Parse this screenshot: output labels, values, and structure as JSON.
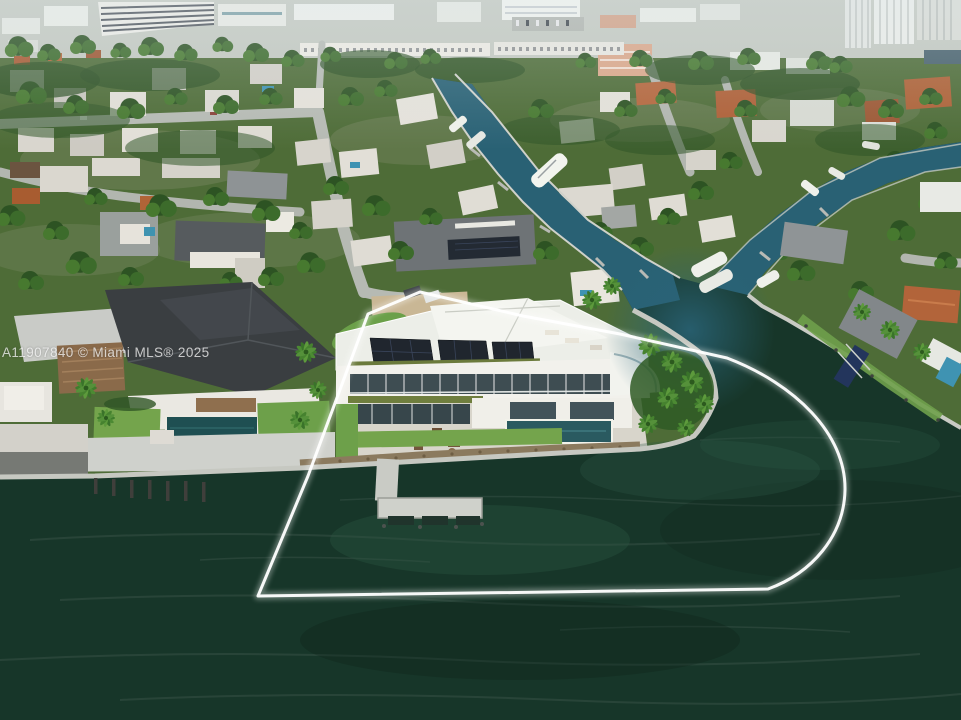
{
  "watermark": {
    "text": "A11907840 © Miami MLS® 2025"
  },
  "scene": {
    "type": "aerial-photo",
    "subject": "waterfront-modern-home-with-property-boundary-outline",
    "colors": {
      "bay_water": "#173629",
      "canal_water": "#2a6478",
      "vegetation": "#4e6c37",
      "lawn": "#74a44c",
      "concrete": "#d8d5cb",
      "roof_dark": "#3a3e41",
      "solar_panel": "#20262e",
      "seawall": "#c6c8c1",
      "riprap": "#8b7a5e",
      "pool_feature": "#2a5a60",
      "pool_neighbor": "#1f4f52",
      "boundary_line": "#ffffff"
    }
  }
}
